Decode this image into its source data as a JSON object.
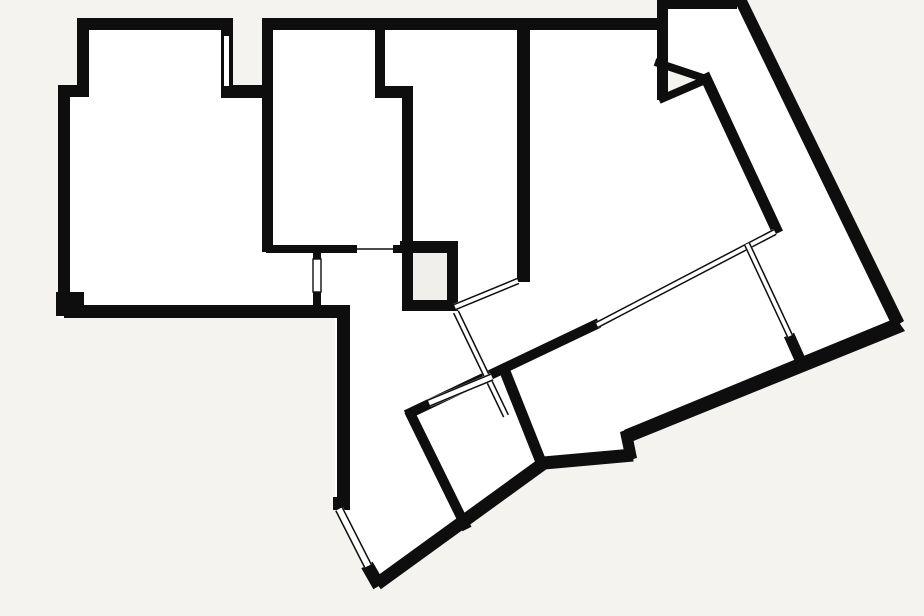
{
  "plan": {
    "canvas": {
      "width": 924,
      "height": 616
    },
    "colors": {
      "background": "#f5f3f0",
      "interior": "#ffffff",
      "wall": "#0e0e0e",
      "shaft_fill": "#f1efeb"
    },
    "footprint": [
      [
        77,
        18
      ],
      [
        233,
        18
      ],
      [
        233,
        85
      ],
      [
        262,
        85
      ],
      [
        262,
        18
      ],
      [
        657,
        18
      ],
      [
        657,
        0
      ],
      [
        740,
        0
      ],
      [
        902,
        326
      ],
      [
        627,
        435
      ],
      [
        633,
        460
      ],
      [
        545,
        468
      ],
      [
        379,
        587
      ],
      [
        368,
        566
      ],
      [
        335,
        506
      ],
      [
        335,
        318
      ],
      [
        58,
        318
      ],
      [
        58,
        85
      ],
      [
        77,
        85
      ]
    ],
    "exterior_patches": [
      {
        "name": "wedge-notch",
        "points": [
          [
            668,
            64
          ],
          [
            700,
            79
          ],
          [
            668,
            94
          ]
        ]
      }
    ],
    "interior_patches": [
      {
        "name": "shaft-room-fill",
        "x": 413,
        "y": 253,
        "w": 34,
        "h": 47
      }
    ],
    "wall_rects": [
      [
        77,
        18,
        156,
        12
      ],
      [
        77,
        18,
        12,
        72
      ],
      [
        58,
        85,
        31,
        12
      ],
      [
        58,
        85,
        12,
        225
      ],
      [
        56,
        292,
        28,
        24
      ],
      [
        64,
        305,
        286,
        13
      ],
      [
        221,
        18,
        12,
        80
      ],
      [
        221,
        85,
        52,
        13
      ],
      [
        262,
        18,
        406,
        12
      ],
      [
        262,
        30,
        11,
        222
      ],
      [
        375,
        28,
        10,
        64
      ],
      [
        375,
        86,
        38,
        12
      ],
      [
        402,
        94,
        11,
        159
      ],
      [
        266,
        245,
        92,
        8
      ],
      [
        392,
        245,
        18,
        8
      ],
      [
        400,
        241,
        58,
        12
      ],
      [
        402,
        241,
        11,
        70
      ],
      [
        447,
        241,
        11,
        70
      ],
      [
        402,
        300,
        56,
        11
      ],
      [
        313,
        250,
        8,
        13
      ],
      [
        313,
        290,
        8,
        17
      ],
      [
        517,
        28,
        13,
        254
      ],
      [
        657,
        0,
        11,
        100
      ],
      [
        657,
        0,
        80,
        9
      ],
      [
        337,
        305,
        13,
        205
      ],
      [
        333,
        497,
        17,
        13
      ]
    ],
    "wall_polygons": [
      {
        "name": "outer-right-diagonal-wall",
        "points": [
          [
            734,
            0
          ],
          [
            747,
            0
          ],
          [
            904,
            321
          ],
          [
            893,
            328
          ]
        ]
      },
      {
        "name": "outer-bottom-diagonal-wall",
        "points": [
          [
            896,
            318
          ],
          [
            905,
            331
          ],
          [
            631,
            442
          ],
          [
            624,
            430
          ]
        ]
      },
      {
        "name": "bottom-notch-jog-wall",
        "points": [
          [
            620,
            432
          ],
          [
            631,
            428
          ],
          [
            637,
            458
          ],
          [
            626,
            461
          ]
        ]
      }
    ],
    "wall_strokes": [
      {
        "name": "bottom-room-base-wall",
        "points": [
          [
            633,
            455
          ],
          [
            544,
            463
          ],
          [
            377,
            584
          ]
        ],
        "width": 13
      },
      {
        "name": "southwest-tip-wall",
        "points": [
          [
            379,
            586
          ],
          [
            367,
            565
          ]
        ],
        "width": 13
      },
      {
        "name": "wedge-upper-edge-wall",
        "points": [
          [
            655,
            62
          ],
          [
            703,
            78
          ]
        ],
        "width": 8
      },
      {
        "name": "wedge-lower-edge-wall",
        "points": [
          [
            659,
            100
          ],
          [
            703,
            81
          ]
        ],
        "width": 8
      },
      {
        "name": "wing-inner-diagonal-wall",
        "points": [
          [
            704,
            74
          ],
          [
            778,
            233
          ]
        ],
        "width": 11
      },
      {
        "name": "long-diagonal-divider-wall",
        "points": [
          [
            406,
            415
          ],
          [
            599,
            323
          ]
        ],
        "width": 10
      },
      {
        "name": "rotated-room-left-wall",
        "points": [
          [
            409,
            411
          ],
          [
            467,
            529
          ]
        ],
        "width": 10
      },
      {
        "name": "rotated-room-right-wall",
        "points": [
          [
            504,
            369
          ],
          [
            543,
            467
          ]
        ],
        "width": 11
      },
      {
        "name": "glass-wall-end-stub",
        "points": [
          [
            789,
            335
          ],
          [
            802,
            364
          ]
        ],
        "width": 11
      }
    ],
    "windows": [
      {
        "name": "shaft-to-divider-glass",
        "x1": 455,
        "y1": 307,
        "x2": 518,
        "y2": 281,
        "width": 7
      },
      {
        "name": "hall-to-wing-door-glass",
        "x1": 456,
        "y1": 312,
        "x2": 506,
        "y2": 416,
        "width": 7
      },
      {
        "name": "rotated-room-top-window",
        "x1": 429,
        "y1": 403,
        "x2": 492,
        "y2": 377,
        "width": 8
      },
      {
        "name": "long-divider-window-band",
        "x1": 597,
        "y1": 325,
        "x2": 775,
        "y2": 232,
        "width": 7
      },
      {
        "name": "wing-cross-glass-wall",
        "x1": 747,
        "y1": 244,
        "x2": 790,
        "y2": 336,
        "width": 7
      },
      {
        "name": "southwest-corner-window",
        "x1": 368,
        "y1": 566,
        "x2": 339,
        "y2": 509,
        "width": 9
      }
    ],
    "white_gaps": [
      {
        "name": "left-block-wall-slit",
        "x": 224,
        "y": 36,
        "w": 5,
        "h": 50,
        "border": false
      },
      {
        "name": "corridor-door-band",
        "x": 313,
        "y": 259,
        "w": 8,
        "h": 33,
        "border": true
      },
      {
        "name": "bedroom-door-opening",
        "x": 357,
        "y": 244,
        "w": 36,
        "h": 10,
        "border": false
      }
    ],
    "thin_lines": [
      {
        "name": "bedroom-door-leaf",
        "x1": 357,
        "y1": 249,
        "x2": 393,
        "y2": 249,
        "width": 1.4
      }
    ]
  }
}
